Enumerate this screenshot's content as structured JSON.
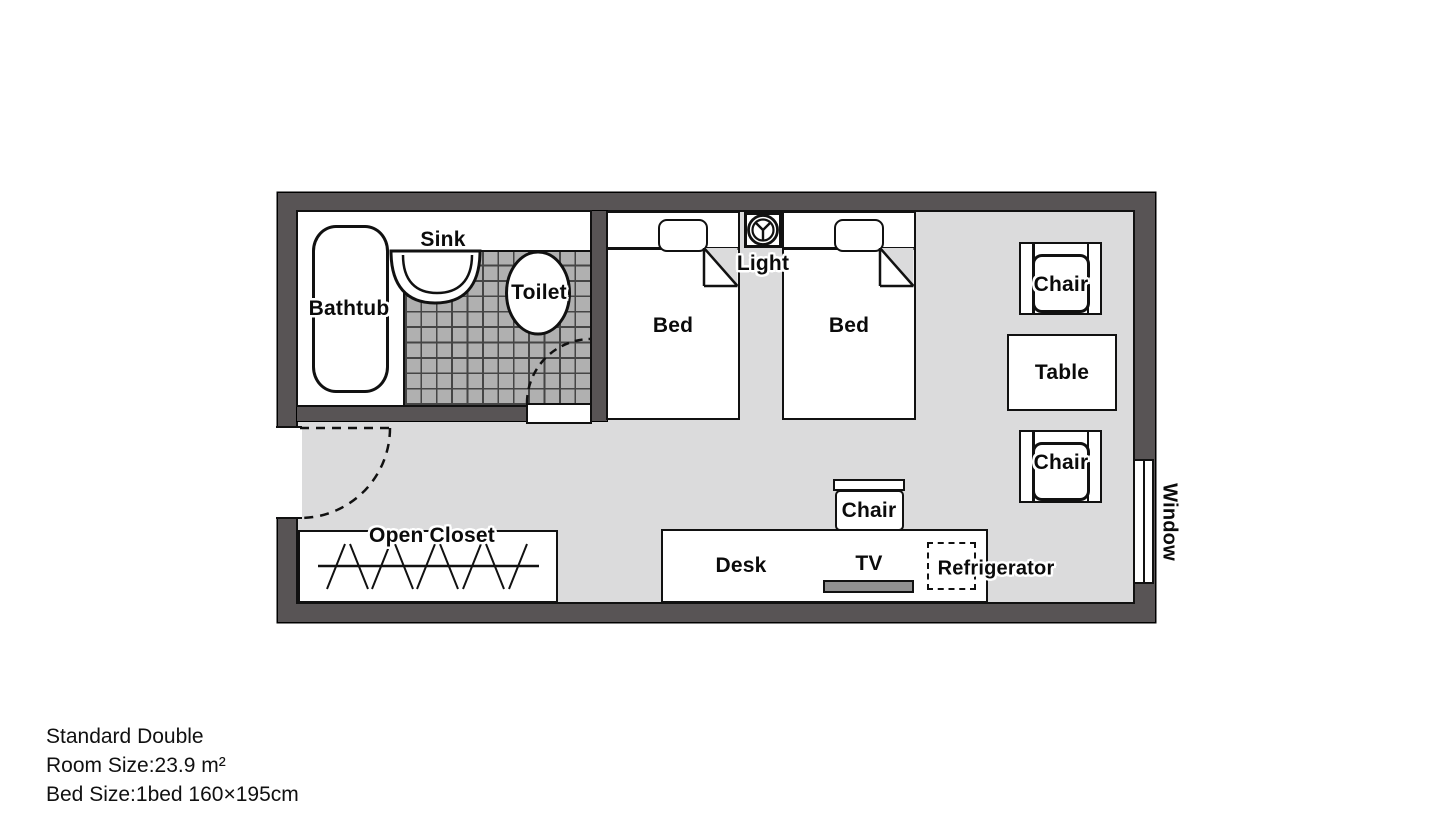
{
  "plan": {
    "labels": {
      "bathtub": "Bathtub",
      "sink": "Sink",
      "toilet": "Toilet",
      "bed_left": "Bed",
      "bed_right": "Bed",
      "light": "Light",
      "chair_top": "Chair",
      "table": "Table",
      "chair_bottom": "Chair",
      "desk_chair": "Chair",
      "desk": "Desk",
      "tv": "TV",
      "refrigerator": "Refrigerator",
      "open_closet": "Open Closet",
      "window": "Window"
    },
    "colors": {
      "wall": "#585455",
      "floor": "#dbdbdc",
      "tile": "#b0b0b0",
      "tile_line": "#454545",
      "tv": "#909090",
      "line": "#111111"
    }
  },
  "info": {
    "title": "Standard Double",
    "room_size": "Room Size:23.9 m²",
    "bed_size": "Bed Size:1bed 160×195cm"
  }
}
